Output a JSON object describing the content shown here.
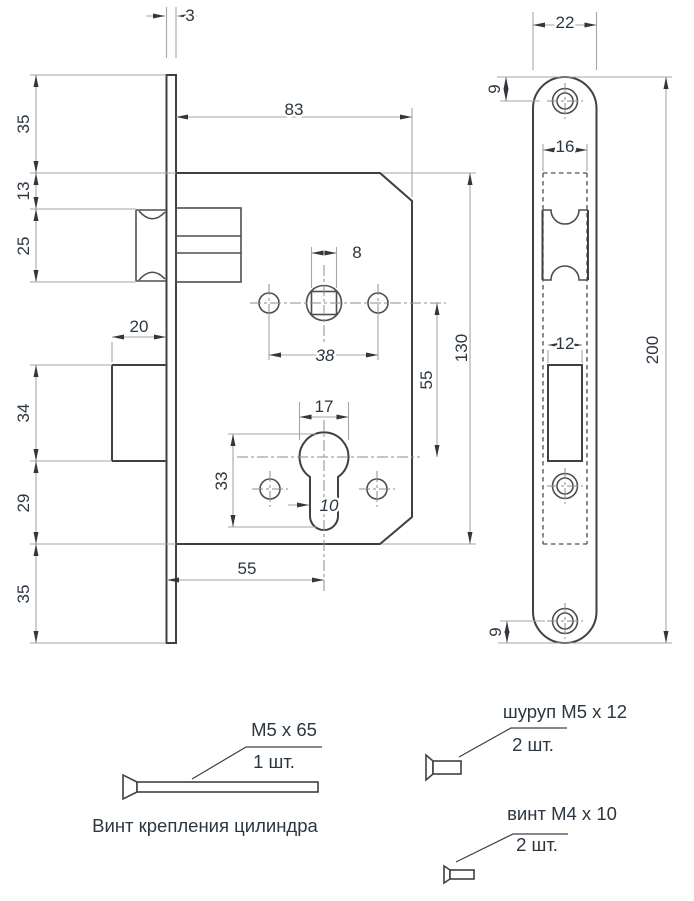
{
  "dims": {
    "plate_thickness": "3",
    "body_depth": "83",
    "top_to_body": "35",
    "body_to_latch": "13",
    "latch_height": "25",
    "bolt_throw": "20",
    "bolt_height": "34",
    "bolt_to_body_bottom": "29",
    "body_bottom_to_plate": "35",
    "spindle_square": "8",
    "fix_hole_spacing": "38",
    "spindle_to_cylinder": "55",
    "body_height": "130",
    "cylinder_dia": "17",
    "cylinder_total": "33",
    "cylinder_slot": "10",
    "backset": "55",
    "plate_width": "22",
    "top_screw_offset": "9",
    "latch_cutout_width": "16",
    "bolt_cutout_width": "12",
    "plate_length": "200",
    "bottom_screw_offset": "9"
  },
  "hardware": [
    {
      "spec": "M5 x 65",
      "qty": "1 шт.",
      "caption": "Винт крепления цилиндра"
    },
    {
      "spec": "шуруп M5 x 12",
      "qty": "2 шт."
    },
    {
      "spec": "винт M4 x 10",
      "qty": "2 шт."
    }
  ],
  "colors": {
    "outline": "#3d4045",
    "dimension": "#a3a6aa",
    "text": "#2c3640"
  }
}
